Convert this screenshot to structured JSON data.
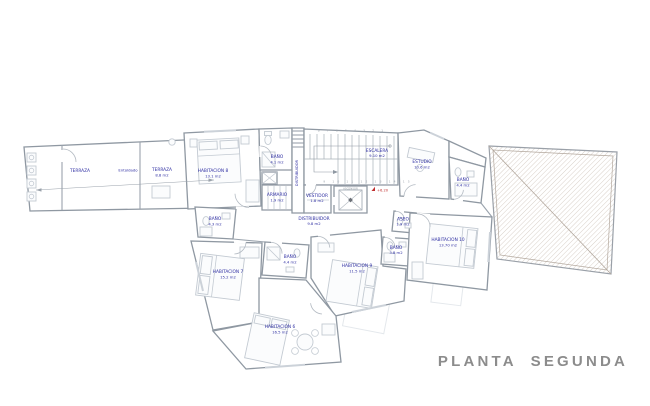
{
  "title": {
    "label": "PLANTA SEGUNDA"
  },
  "colors": {
    "label_blue": "#2e2ea2",
    "wall_gray": "#8f98a2",
    "furniture_gray": "#c3cad2",
    "roof_hatch": "#c9bcb1",
    "level_red": "#c03030",
    "title_gray": "#8c8c8c"
  },
  "rooms": [
    {
      "name": "TERRAZA",
      "area": ""
    },
    {
      "name": "TERRAZA",
      "area": "8.8 m2"
    },
    {
      "name": "HABITACION 8",
      "area": "13.1 m2"
    },
    {
      "name": "BAÑO",
      "area": "4.1 m2"
    },
    {
      "name": "ARMARIO",
      "area": "1.9 m2"
    },
    {
      "name": "BAÑO",
      "area": "4.3 m2"
    },
    {
      "name": "DISTRIBUIDOR",
      "area": ""
    },
    {
      "name": "VESTIDOR",
      "area": "1.8 m2"
    },
    {
      "name": "ESCALERA",
      "area": "9.10 m2"
    },
    {
      "name": "ESTUDIO",
      "area": "10.6 m2"
    },
    {
      "name": "BAÑO",
      "area": "4.4 m2"
    },
    {
      "name": "DISTRIBUIDOR",
      "area": "9.8 m2"
    },
    {
      "name": "ASEO",
      "area": "1.9 m2"
    },
    {
      "name": "BAÑO",
      "area": "3.8 m2"
    },
    {
      "name": "HABITACION 10",
      "area": "13.70 m2"
    },
    {
      "name": "HABITACION 9",
      "area": "11.5 m2"
    },
    {
      "name": "BAÑO",
      "area": "4.4 m2"
    },
    {
      "name": "HABITACION 7",
      "area": "15.2 m2"
    },
    {
      "name": "HABITACION 6",
      "area": "16.5 m2"
    }
  ],
  "annotations": {
    "deck_note": "Entoldado",
    "elevator": "ASCENSOR",
    "level_mark": "+6.20",
    "stair_numbers_top": "8 7 6 5 4 3 2 1",
    "stair_numbers_bottom": "9 10 11 12 13 14 15"
  }
}
